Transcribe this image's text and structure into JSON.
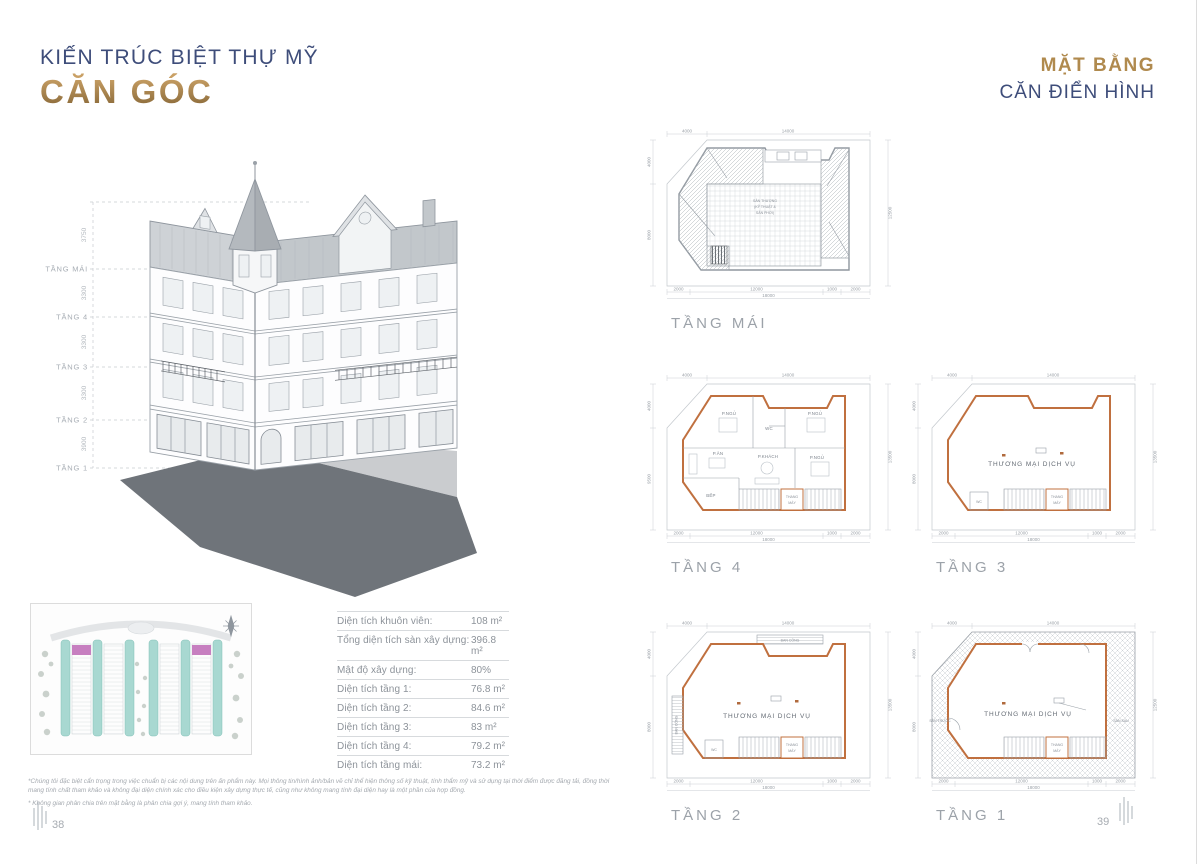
{
  "header": {
    "left_sub": "KIẾN TRÚC BIỆT THỰ MỸ",
    "left_main": "CĂN GÓC",
    "right_line1": "MẶT BẰNG",
    "right_line2": "CĂN ĐIỂN HÌNH"
  },
  "elevation": {
    "floors": [
      "TẦNG MÁI",
      "TẦNG 4",
      "TẦNG 3",
      "TẦNG 2",
      "TẦNG 1"
    ],
    "heights": [
      "3750",
      "3300",
      "3300",
      "3300",
      "3900"
    ]
  },
  "specs": {
    "rows": [
      {
        "label": "Diện tích khuôn viên:",
        "value": "108 m²"
      },
      {
        "label": "Tổng diện tích sàn xây dựng:",
        "value": "396.8 m²"
      },
      {
        "label": "Mật độ xây dựng:",
        "value": "80%"
      },
      {
        "label": "Diện tích tầng 1:",
        "value": "76.8 m²"
      },
      {
        "label": "Diện tích tầng 2:",
        "value": "84.6 m²"
      },
      {
        "label": "Diện tích tầng 3:",
        "value": "83 m²"
      },
      {
        "label": "Diện tích tầng 4:",
        "value": "79.2 m²"
      },
      {
        "label": "Diện tích tầng mái:",
        "value": "73.2 m²"
      }
    ]
  },
  "plans": {
    "roof": {
      "label": "TẦNG MÁI",
      "line1": "SÂN THƯỢNG",
      "line2": "(KỸ THUẬT &",
      "line3": "SÂN PHƠI)"
    },
    "f4": {
      "label": "TẦNG 4",
      "bed": "P.NGỦ",
      "wc": "WC",
      "dining": "P.ĂN",
      "living": "P.KHÁCH",
      "kitchen": "BẾP",
      "lift1": "THANG",
      "lift2": "MÁY"
    },
    "f3": {
      "label": "TẦNG 3",
      "main": "THƯƠNG MẠI DỊCH VỤ",
      "wc": "WC",
      "lift1": "THANG",
      "lift2": "MÁY"
    },
    "f2": {
      "label": "TẦNG 2",
      "main": "THƯƠNG MẠI DỊCH VỤ",
      "balcony": "BAN CÔNG",
      "wc": "WC",
      "lift1": "THANG",
      "lift2": "MÁY"
    },
    "f1": {
      "label": "TẦNG 1",
      "main": "THƯƠNG MẠI DỊCH VỤ",
      "front": "SÂN TRƯỚC",
      "back": "SÂN SAU",
      "lift1": "THANG",
      "lift2": "MÁY"
    }
  },
  "dims": {
    "top1": "4000",
    "top2": "14000",
    "left1": "4000",
    "left2": "8000",
    "left2_f4": "9500",
    "right_roof": "12500",
    "right_f4": "13500",
    "right_f3": "13500",
    "right_f2": "13500",
    "right_f1": "12500",
    "b1": "2000",
    "b2": "12000",
    "b3": "1000",
    "b4": "2000",
    "total": "18000"
  },
  "footnotes": {
    "p1": "*Chúng tôi đặc biệt cẩn trọng trong việc chuẩn bị các nội dung trên ấn phẩm này. Mọi thông tin/hình ảnh/bản vẽ chỉ thể hiện thông số kỹ thuật, tính thẩm mỹ và sử dụng tại thời điểm được đăng tải, đồng thời mang tính chất tham khảo và không đại diện chính xác cho điều kiện xây dựng thực tế, cũng như không mang tính đại diện hay là một phần của hợp đồng.",
    "p2": "* Không gian phân chia trên mặt bằng là phân chia gợi ý, mang tính tham khảo."
  },
  "pages": {
    "left": "38",
    "right": "39"
  },
  "colors": {
    "accent_blue": "#3e4d7a",
    "accent_gold": "#b08a4e",
    "plan_wall_orange": "#c0703f",
    "highlight_pink": "#c77fc0",
    "site_teal": "#a8d8d1",
    "shadow_gray": "#6f747a"
  }
}
